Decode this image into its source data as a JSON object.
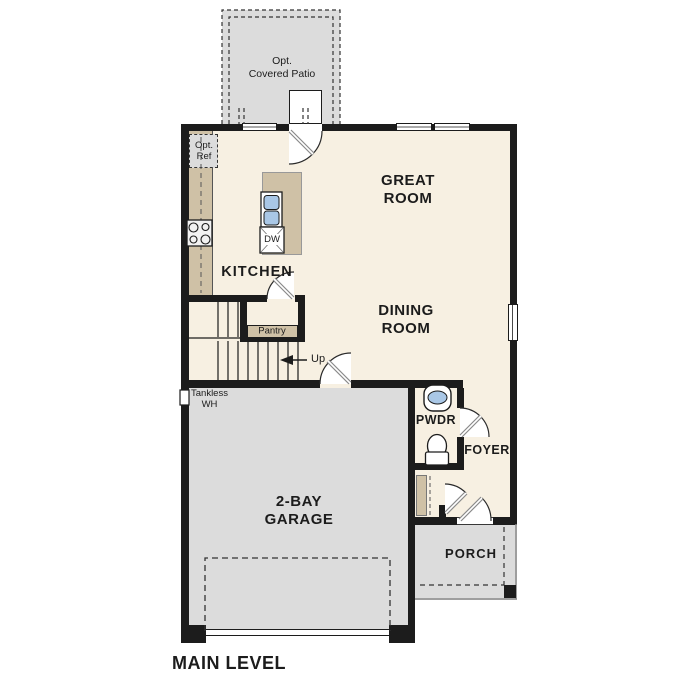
{
  "plan": {
    "title": "MAIN LEVEL"
  },
  "rooms": {
    "patio": {
      "label": "Opt.\nCovered Patio"
    },
    "great_room": {
      "label": "GREAT\nROOM"
    },
    "dining_room": {
      "label": "DINING\nROOM"
    },
    "kitchen": {
      "label": "KITCHEN"
    },
    "pantry": {
      "label": "Pantry"
    },
    "garage": {
      "label": "2-BAY\nGARAGE"
    },
    "pwdr": {
      "label": "PWDR"
    },
    "foyer": {
      "label": "FOYER"
    },
    "porch": {
      "label": "PORCH"
    }
  },
  "annotations": {
    "opt_ref": "Opt.\nRef",
    "tankless_wh": "Tankless\nWH",
    "stairs_up": "Up",
    "dishwasher": "DW"
  },
  "colors": {
    "floor": "#f7f0e2",
    "outdoor": "#dcdcdc",
    "counter": "#cfc1a6",
    "wall": "#1c1c1c",
    "fixture_blue": "#a9c7e6"
  }
}
